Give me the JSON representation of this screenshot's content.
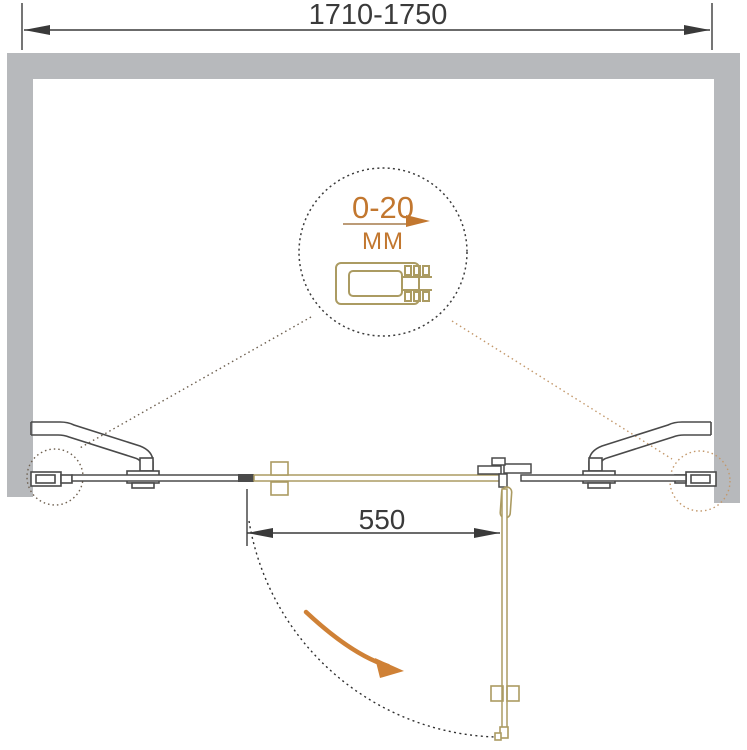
{
  "diagram": {
    "type": "shower-door-installation-top-view",
    "overall_width_label": "1710-1750",
    "door_width_label": "550",
    "detail": {
      "range_label": "0-20",
      "unit_label": "MM"
    }
  },
  "colors": {
    "wall_gray": "#b7b9bc",
    "line_dark": "#4a4a4a",
    "accent_orange": "#c2772f",
    "hardware_tan": "#ab9b62",
    "leader_left": "#6e6050",
    "leader_right": "#c3986b"
  }
}
